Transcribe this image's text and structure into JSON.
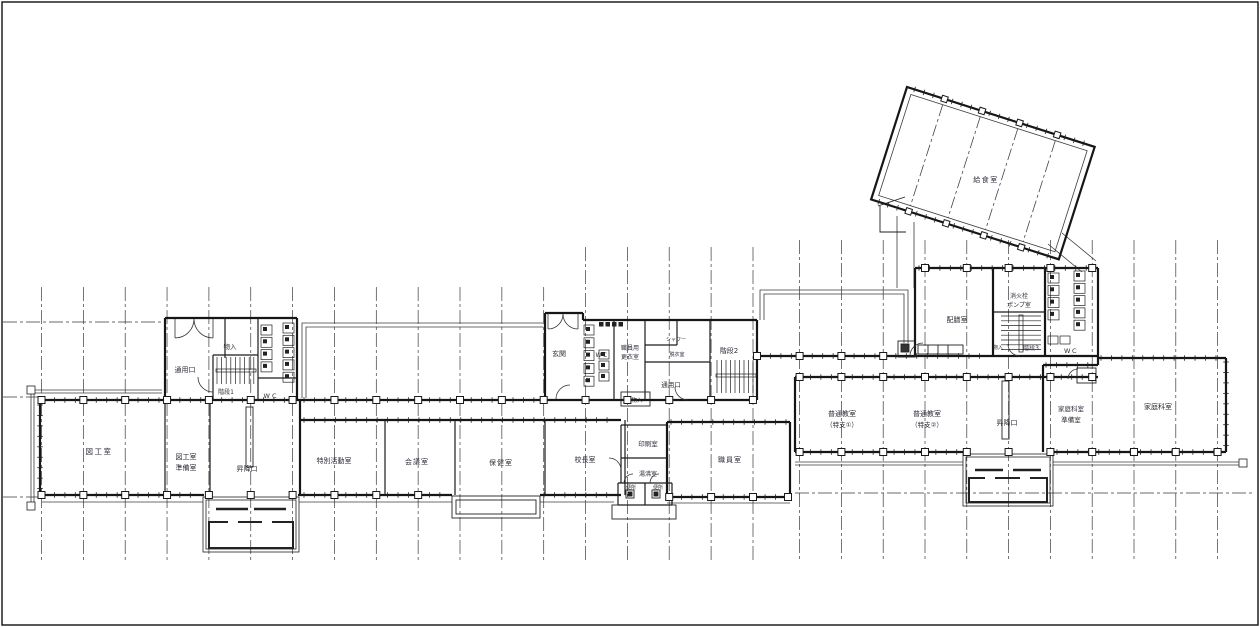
{
  "document": {
    "type": "architectural-floor-plan",
    "language": "ja"
  },
  "rooms": {
    "art_room": "図工室",
    "art_prep_line1": "図工室",
    "art_prep_line2": "準備室",
    "entrance_hall_left": "昇降口",
    "service_entrance_left": "通用口",
    "storage_left": "物入",
    "stairs1": "階段1",
    "wc_left": "WC",
    "special_activity": "特別活動室",
    "meeting": "会議室",
    "health": "保健室",
    "principal": "校長室",
    "front_entrance": "玄関",
    "wc_mid": "WC",
    "staff_locker_line1": "職員用",
    "staff_locker_line2": "更衣室",
    "shower": "シャワー",
    "dressing": "脱衣室",
    "service_entrance_mid": "通用口",
    "storage_mid": "物入",
    "stairs2": "階段2",
    "print_room": "印刷室",
    "kitchenette": "湯沸室",
    "toilet_small_left": "便所",
    "toilet_small_right": "便所",
    "staff_room": "職員室",
    "classroom1_line1": "普通教室",
    "classroom1_line2": "（特支①）",
    "classroom2_line1": "普通教室",
    "classroom2_line2": "（特支②）",
    "entrance_hall_right": "昇降口",
    "home_ec_prep_line1": "家庭科室",
    "home_ec_prep_line2": "準備室",
    "home_ec_room": "家庭科室",
    "serving_room": "配膳室",
    "pump_room_line1": "消火栓",
    "pump_room_line2": "ポンプ室",
    "stairs3": "階段3",
    "storage_right": "物入",
    "wc_right": "WC",
    "lunch_room": "給食室"
  }
}
